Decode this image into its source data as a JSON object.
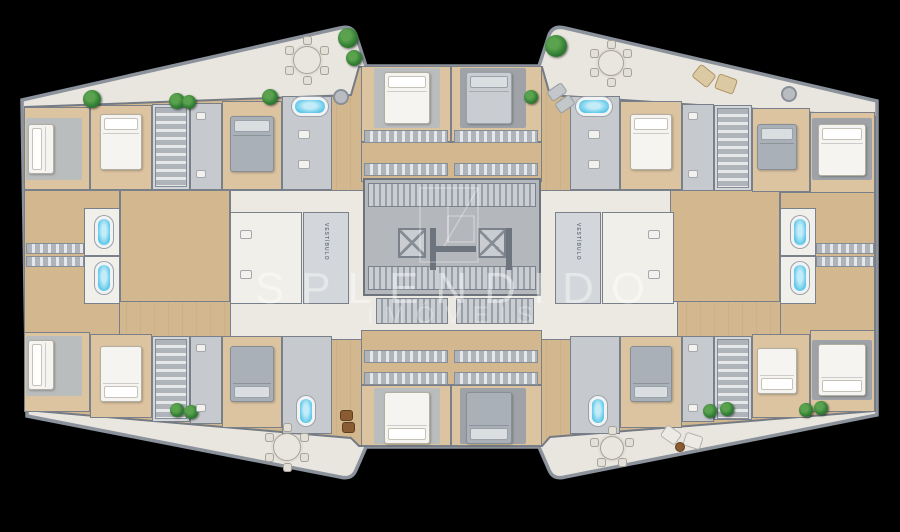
{
  "meta": {
    "width": 900,
    "height": 532,
    "background": "#000000"
  },
  "watermark": {
    "brand": "SPLENDIDO",
    "subtitle": "IMÓVEIS",
    "text_color": "rgba(255,255,255,0.42)",
    "logo": "splendido-monogram"
  },
  "labels": {
    "vestibule": "VESTÍBULO"
  },
  "colors": {
    "background": "#000000",
    "balcony": "#e9e6df",
    "wood": "#d3b78e",
    "wood_light": "#dcc4a1",
    "wall": "#79808a",
    "wall_dark": "#6e747d",
    "gray_room": "#c6c9cd",
    "core": "#b4b7bb",
    "corridor": "#ebe9e2",
    "tub_blue": "#59c6e8",
    "plant_green": "#2f7c33",
    "lounger_beige": "#dbc9a4",
    "bed_white": "#f5f4f0"
  },
  "plan": {
    "outer_path": "M22,100 L340,28 Q352,25 356,35 L366,66 L539,66 L549,35 Q553,25 565,28 L877,101 L877,415 L565,477 Q553,480 549,470 L539,447 L366,447 L356,470 Q352,480 340,477 L27,416 Z",
    "inner_path": "M25,107 L351,95 L359,67 L542,67 L550,95 L875,117 L875,411 L550,437 L542,446 L359,446 L351,438 L25,410 Z",
    "rooms": [
      {
        "x": 230,
        "y": 190,
        "w": 448,
        "h": 150,
        "f": "white",
        "n": "corridor"
      },
      {
        "x": 120,
        "y": 190,
        "w": 110,
        "h": 112,
        "f": "wood",
        "n": "living-left"
      },
      {
        "x": 670,
        "y": 190,
        "w": 110,
        "h": 112,
        "f": "wood",
        "n": "living-right"
      },
      {
        "x": 24,
        "y": 107,
        "w": 66,
        "h": 83,
        "f": "wood2",
        "n": "bedroom"
      },
      {
        "x": 90,
        "y": 105,
        "w": 62,
        "h": 85,
        "f": "wood2",
        "n": "bedroom"
      },
      {
        "x": 152,
        "y": 104,
        "w": 38,
        "h": 86,
        "f": "light",
        "n": "closet-room"
      },
      {
        "x": 190,
        "y": 103,
        "w": 32,
        "h": 87,
        "f": "gray",
        "n": "bathroom"
      },
      {
        "x": 222,
        "y": 101,
        "w": 60,
        "h": 89,
        "f": "wood2",
        "n": "bedroom"
      },
      {
        "x": 282,
        "y": 96,
        "w": 50,
        "h": 94,
        "f": "gray",
        "n": "bathroom"
      },
      {
        "x": 361,
        "y": 66,
        "w": 90,
        "h": 76,
        "f": "wood2",
        "n": "bedroom"
      },
      {
        "x": 451,
        "y": 66,
        "w": 91,
        "h": 76,
        "f": "wood2",
        "n": "bedroom"
      },
      {
        "x": 361,
        "y": 142,
        "w": 181,
        "h": 40,
        "f": "wood",
        "n": "closet-hall"
      },
      {
        "x": 570,
        "y": 96,
        "w": 50,
        "h": 94,
        "f": "gray",
        "n": "bathroom"
      },
      {
        "x": 620,
        "y": 101,
        "w": 62,
        "h": 89,
        "f": "wood2",
        "n": "bedroom"
      },
      {
        "x": 682,
        "y": 104,
        "w": 32,
        "h": 87,
        "f": "gray",
        "n": "bathroom"
      },
      {
        "x": 714,
        "y": 105,
        "w": 38,
        "h": 86,
        "f": "light",
        "n": "closet-room"
      },
      {
        "x": 752,
        "y": 108,
        "w": 58,
        "h": 84,
        "f": "wood2",
        "n": "bedroom"
      },
      {
        "x": 810,
        "y": 112,
        "w": 65,
        "h": 82,
        "f": "wood2",
        "n": "bedroom"
      },
      {
        "x": 24,
        "y": 190,
        "w": 96,
        "h": 145,
        "f": "wood",
        "n": "suite-left"
      },
      {
        "x": 84,
        "y": 208,
        "w": 36,
        "h": 48,
        "f": "white2",
        "n": "bathroom"
      },
      {
        "x": 84,
        "y": 256,
        "w": 36,
        "h": 48,
        "f": "white2",
        "n": "bathroom"
      },
      {
        "x": 780,
        "y": 192,
        "w": 95,
        "h": 143,
        "f": "wood",
        "n": "suite-right"
      },
      {
        "x": 780,
        "y": 208,
        "w": 36,
        "h": 48,
        "f": "white2",
        "n": "bathroom"
      },
      {
        "x": 780,
        "y": 256,
        "w": 36,
        "h": 48,
        "f": "white2",
        "n": "bathroom"
      },
      {
        "x": 230,
        "y": 212,
        "w": 72,
        "h": 92,
        "f": "white2",
        "n": "bathroom"
      },
      {
        "x": 602,
        "y": 212,
        "w": 72,
        "h": 92,
        "f": "white2",
        "n": "bathroom"
      },
      {
        "x": 361,
        "y": 330,
        "w": 181,
        "h": 55,
        "f": "wood",
        "n": "closet-hall"
      },
      {
        "x": 361,
        "y": 385,
        "w": 90,
        "h": 61,
        "f": "wood2",
        "n": "bedroom"
      },
      {
        "x": 451,
        "y": 385,
        "w": 91,
        "h": 61,
        "f": "wood2",
        "n": "bedroom"
      },
      {
        "x": 24,
        "y": 332,
        "w": 66,
        "h": 80,
        "f": "wood2",
        "n": "bedroom"
      },
      {
        "x": 90,
        "y": 334,
        "w": 62,
        "h": 84,
        "f": "wood2",
        "n": "bedroom"
      },
      {
        "x": 152,
        "y": 336,
        "w": 38,
        "h": 86,
        "f": "light",
        "n": "closet-room"
      },
      {
        "x": 190,
        "y": 336,
        "w": 32,
        "h": 88,
        "f": "gray",
        "n": "bathroom"
      },
      {
        "x": 222,
        "y": 336,
        "w": 60,
        "h": 92,
        "f": "wood2",
        "n": "bedroom"
      },
      {
        "x": 282,
        "y": 336,
        "w": 50,
        "h": 98,
        "f": "gray",
        "n": "bathroom"
      },
      {
        "x": 570,
        "y": 336,
        "w": 50,
        "h": 98,
        "f": "gray",
        "n": "bathroom"
      },
      {
        "x": 620,
        "y": 336,
        "w": 62,
        "h": 92,
        "f": "wood2",
        "n": "bedroom"
      },
      {
        "x": 682,
        "y": 336,
        "w": 32,
        "h": 86,
        "f": "gray",
        "n": "bathroom"
      },
      {
        "x": 714,
        "y": 336,
        "w": 38,
        "h": 84,
        "f": "light",
        "n": "closet-room"
      },
      {
        "x": 752,
        "y": 334,
        "w": 58,
        "h": 84,
        "f": "wood2",
        "n": "bedroom"
      },
      {
        "x": 810,
        "y": 330,
        "w": 65,
        "h": 82,
        "f": "wood2",
        "n": "bedroom"
      }
    ],
    "vestibules": [
      {
        "x": 303,
        "y": 212,
        "w": 46,
        "h": 92
      },
      {
        "x": 555,
        "y": 212,
        "w": 46,
        "h": 92
      }
    ],
    "core": {
      "x": 363,
      "y": 178,
      "w": 178,
      "h": 118
    },
    "stairs": [
      {
        "x": 368,
        "y": 183,
        "w": 168,
        "h": 24
      },
      {
        "x": 368,
        "y": 266,
        "w": 168,
        "h": 24
      },
      {
        "x": 376,
        "y": 298,
        "w": 72,
        "h": 26
      },
      {
        "x": 456,
        "y": 298,
        "w": 78,
        "h": 26
      }
    ],
    "elevators": [
      {
        "x": 398,
        "y": 228,
        "w": 28,
        "h": 30
      },
      {
        "x": 478,
        "y": 228,
        "w": 28,
        "h": 30
      }
    ],
    "core_walls": [
      {
        "x": 430,
        "y": 228,
        "w": 6,
        "h": 42
      },
      {
        "x": 436,
        "y": 246,
        "w": 40,
        "h": 6
      },
      {
        "x": 506,
        "y": 228,
        "w": 6,
        "h": 42
      }
    ],
    "closets": [
      {
        "x": 155,
        "y": 107,
        "w": 32,
        "h": 80,
        "d": "v"
      },
      {
        "x": 717,
        "y": 108,
        "w": 32,
        "h": 80,
        "d": "v"
      },
      {
        "x": 155,
        "y": 339,
        "w": 32,
        "h": 80,
        "d": "v"
      },
      {
        "x": 717,
        "y": 339,
        "w": 32,
        "h": 80,
        "d": "v"
      },
      {
        "x": 364,
        "y": 130,
        "w": 84,
        "h": 13,
        "d": "h"
      },
      {
        "x": 454,
        "y": 130,
        "w": 84,
        "h": 13,
        "d": "h"
      },
      {
        "x": 364,
        "y": 163,
        "w": 84,
        "h": 13,
        "d": "h"
      },
      {
        "x": 454,
        "y": 163,
        "w": 84,
        "h": 13,
        "d": "h"
      },
      {
        "x": 364,
        "y": 350,
        "w": 84,
        "h": 13,
        "d": "h"
      },
      {
        "x": 454,
        "y": 350,
        "w": 84,
        "h": 13,
        "d": "h"
      },
      {
        "x": 364,
        "y": 372,
        "w": 84,
        "h": 13,
        "d": "h"
      },
      {
        "x": 454,
        "y": 372,
        "w": 84,
        "h": 13,
        "d": "h"
      },
      {
        "x": 26,
        "y": 243,
        "w": 58,
        "h": 11,
        "d": "h"
      },
      {
        "x": 26,
        "y": 256,
        "w": 58,
        "h": 11,
        "d": "h"
      },
      {
        "x": 816,
        "y": 243,
        "w": 58,
        "h": 11,
        "d": "h"
      },
      {
        "x": 816,
        "y": 256,
        "w": 58,
        "h": 11,
        "d": "h"
      }
    ],
    "rugs": [
      {
        "x": 26,
        "y": 118,
        "w": 56,
        "h": 62,
        "c": "l"
      },
      {
        "x": 374,
        "y": 68,
        "w": 66,
        "h": 60,
        "c": "l"
      },
      {
        "x": 460,
        "y": 68,
        "w": 66,
        "h": 60,
        "c": "d"
      },
      {
        "x": 812,
        "y": 118,
        "w": 60,
        "h": 62,
        "c": "d"
      },
      {
        "x": 26,
        "y": 336,
        "w": 56,
        "h": 60,
        "c": "l"
      },
      {
        "x": 374,
        "y": 388,
        "w": 66,
        "h": 56,
        "c": "l"
      },
      {
        "x": 460,
        "y": 388,
        "w": 66,
        "h": 56,
        "c": "d"
      },
      {
        "x": 812,
        "y": 340,
        "w": 60,
        "h": 60,
        "c": "d"
      }
    ],
    "beds": [
      {
        "x": 28,
        "y": 124,
        "w": 26,
        "h": 50,
        "c": "white",
        "p": "left"
      },
      {
        "x": 100,
        "y": 114,
        "w": 42,
        "h": 56,
        "c": "white",
        "p": "top"
      },
      {
        "x": 230,
        "y": 116,
        "w": 44,
        "h": 56,
        "c": "gray",
        "p": "top"
      },
      {
        "x": 384,
        "y": 72,
        "w": 46,
        "h": 52,
        "c": "white",
        "p": "top"
      },
      {
        "x": 466,
        "y": 72,
        "w": 46,
        "h": 52,
        "c": "grayl",
        "p": "top"
      },
      {
        "x": 630,
        "y": 114,
        "w": 42,
        "h": 56,
        "c": "white",
        "p": "top"
      },
      {
        "x": 757,
        "y": 124,
        "w": 40,
        "h": 46,
        "c": "gray",
        "p": "top"
      },
      {
        "x": 818,
        "y": 124,
        "w": 48,
        "h": 52,
        "c": "white",
        "p": "top"
      },
      {
        "x": 28,
        "y": 340,
        "w": 26,
        "h": 50,
        "c": "white",
        "p": "left"
      },
      {
        "x": 100,
        "y": 346,
        "w": 42,
        "h": 56,
        "c": "white",
        "p": "bottom"
      },
      {
        "x": 230,
        "y": 346,
        "w": 44,
        "h": 56,
        "c": "gray",
        "p": "bottom"
      },
      {
        "x": 384,
        "y": 392,
        "w": 46,
        "h": 52,
        "c": "white",
        "p": "bottom"
      },
      {
        "x": 466,
        "y": 392,
        "w": 46,
        "h": 52,
        "c": "gray",
        "p": "bottom"
      },
      {
        "x": 630,
        "y": 346,
        "w": 42,
        "h": 56,
        "c": "gray",
        "p": "bottom"
      },
      {
        "x": 757,
        "y": 348,
        "w": 40,
        "h": 46,
        "c": "white",
        "p": "bottom"
      },
      {
        "x": 818,
        "y": 344,
        "w": 48,
        "h": 52,
        "c": "white",
        "p": "bottom"
      }
    ],
    "tubs": [
      {
        "x": 292,
        "y": 97,
        "w": 36,
        "h": 19
      },
      {
        "x": 576,
        "y": 97,
        "w": 36,
        "h": 19
      },
      {
        "x": 95,
        "y": 216,
        "w": 18,
        "h": 32
      },
      {
        "x": 95,
        "y": 262,
        "w": 18,
        "h": 32
      },
      {
        "x": 791,
        "y": 216,
        "w": 18,
        "h": 32
      },
      {
        "x": 791,
        "y": 262,
        "w": 18,
        "h": 32
      },
      {
        "x": 297,
        "y": 396,
        "w": 18,
        "h": 30
      },
      {
        "x": 589,
        "y": 396,
        "w": 18,
        "h": 30
      }
    ],
    "plants": [
      {
        "x": 92,
        "y": 99,
        "r": 9
      },
      {
        "x": 177,
        "y": 101,
        "r": 8
      },
      {
        "x": 189,
        "y": 102,
        "r": 7
      },
      {
        "x": 270,
        "y": 97,
        "r": 8
      },
      {
        "x": 348,
        "y": 38,
        "r": 10
      },
      {
        "x": 354,
        "y": 58,
        "r": 8
      },
      {
        "x": 556,
        "y": 46,
        "r": 11
      },
      {
        "x": 531,
        "y": 97,
        "r": 7
      },
      {
        "x": 177,
        "y": 410,
        "r": 7
      },
      {
        "x": 191,
        "y": 412,
        "r": 7
      },
      {
        "x": 710,
        "y": 411,
        "r": 7
      },
      {
        "x": 727,
        "y": 409,
        "r": 7
      },
      {
        "x": 806,
        "y": 410,
        "r": 7
      },
      {
        "x": 821,
        "y": 408,
        "r": 7
      }
    ],
    "tables": [
      {
        "x": 307,
        "y": 60,
        "r": 14,
        "n": 6
      },
      {
        "x": 611,
        "y": 63,
        "r": 13,
        "n": 6
      },
      {
        "x": 287,
        "y": 447,
        "r": 14,
        "n": 6
      },
      {
        "x": 612,
        "y": 448,
        "r": 12,
        "n": 5
      }
    ],
    "loungers": [
      {
        "x": 694,
        "y": 68,
        "w": 20,
        "h": 16,
        "rot": 38,
        "c": "beige"
      },
      {
        "x": 716,
        "y": 76,
        "w": 20,
        "h": 16,
        "rot": 20,
        "c": "beige"
      },
      {
        "x": 548,
        "y": 86,
        "w": 18,
        "h": 12,
        "rot": -35,
        "c": "gray"
      },
      {
        "x": 556,
        "y": 98,
        "w": 18,
        "h": 12,
        "rot": -35,
        "c": "gray"
      },
      {
        "x": 662,
        "y": 428,
        "w": 18,
        "h": 14,
        "rot": 35,
        "c": "white"
      },
      {
        "x": 684,
        "y": 434,
        "w": 18,
        "h": 14,
        "rot": 18,
        "c": "white"
      },
      {
        "x": 340,
        "y": 410,
        "w": 13,
        "h": 11,
        "rot": 0,
        "c": "brown"
      },
      {
        "x": 342,
        "y": 422,
        "w": 13,
        "h": 11,
        "rot": 0,
        "c": "brown"
      }
    ],
    "dots": [
      {
        "x": 341,
        "y": 97,
        "r": 8,
        "c": "col"
      },
      {
        "x": 789,
        "y": 94,
        "r": 8,
        "c": "col"
      },
      {
        "x": 680,
        "y": 447,
        "r": 5,
        "c": "brown"
      }
    ],
    "fixtures": [
      {
        "x": 196,
        "y": 112,
        "w": 10,
        "h": 8
      },
      {
        "x": 196,
        "y": 170,
        "w": 10,
        "h": 8
      },
      {
        "x": 688,
        "y": 112,
        "w": 10,
        "h": 8
      },
      {
        "x": 688,
        "y": 170,
        "w": 10,
        "h": 8
      },
      {
        "x": 196,
        "y": 344,
        "w": 10,
        "h": 8
      },
      {
        "x": 196,
        "y": 404,
        "w": 10,
        "h": 8
      },
      {
        "x": 688,
        "y": 344,
        "w": 10,
        "h": 8
      },
      {
        "x": 688,
        "y": 404,
        "w": 10,
        "h": 8
      },
      {
        "x": 298,
        "y": 130,
        "w": 12,
        "h": 9
      },
      {
        "x": 298,
        "y": 160,
        "w": 12,
        "h": 9
      },
      {
        "x": 588,
        "y": 130,
        "w": 12,
        "h": 9
      },
      {
        "x": 588,
        "y": 160,
        "w": 12,
        "h": 9
      },
      {
        "x": 240,
        "y": 230,
        "w": 12,
        "h": 9
      },
      {
        "x": 240,
        "y": 270,
        "w": 12,
        "h": 9
      },
      {
        "x": 648,
        "y": 230,
        "w": 12,
        "h": 9
      },
      {
        "x": 648,
        "y": 270,
        "w": 12,
        "h": 9
      }
    ]
  }
}
